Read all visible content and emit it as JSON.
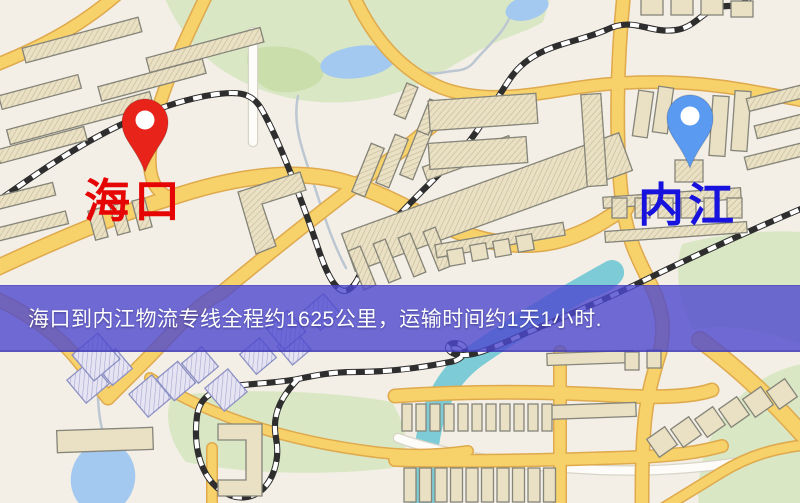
{
  "banner": {
    "text": "海口到内江物流专线全程约1625公里，运输时间约1天1小时.",
    "bg": "rgba(78,72,206,0.80)",
    "text_color": "#ffffff",
    "top": 285,
    "height": 67,
    "pad_left": 28
  },
  "markers": [
    {
      "id": "origin",
      "label": "海口",
      "label_color": "#e60505",
      "pin_color": "#e8231a",
      "x": 145,
      "y": 172,
      "label_x": 84,
      "label_y": 178,
      "label_size": 46
    },
    {
      "id": "destination",
      "label": "内江",
      "label_color": "#1712dd",
      "pin_color": "#5a9af0",
      "x": 690,
      "y": 168,
      "label_x": 638,
      "label_y": 182,
      "label_size": 46
    }
  ],
  "map": {
    "bg": "#f3efe6",
    "road_color": "#f7d169",
    "road_casing": "#dfa94d",
    "minor_road_color": "#fdfcf8",
    "minor_road_casing": "#d8d4c8",
    "railway_dark": "#2e2e2e",
    "railway_light": "#ffffff",
    "building_fill": "#eae0c4",
    "building_stroke": "#85857a",
    "building_blue_fill": "#e6e4f2",
    "building_blue_stroke": "#8d92c4",
    "green": "#d9e7c4",
    "green_dark": "#c9deaa",
    "pond": "#a3c9f0",
    "river": "#7ccbd6",
    "stream": "#bcc7d2",
    "greens": [
      {
        "d": "M 162,-8 C 178,30 200,58 232,76 C 272,99 322,108 372,99 C 420,91 455,62 488,46 C 506,37 526,32 543,22 L 552,-8 Z",
        "c": "green"
      },
      {
        "d": "M 250,50 C 280,42 310,48 322,66 C 330,82 305,94 280,92 C 255,90 240,62 250,50 Z",
        "c": "green_dark"
      },
      {
        "d": "M 682,244 C 728,232 778,229 812,233 L 812,348 C 772,332 724,322 694,330 C 678,300 674,268 682,244 Z",
        "c": "green"
      },
      {
        "d": "M 812,362 C 772,368 742,388 722,418 C 702,448 696,478 699,512 L 812,512 Z",
        "c": "green"
      },
      {
        "d": "M 172,396 C 230,388 330,390 392,402 C 412,436 408,458 392,468 C 330,476 240,474 186,462 C 168,440 164,414 172,396 Z",
        "c": "green"
      }
    ],
    "streams": [
      "M 298,96 C 292,125 303,152 313,182 C 322,208 330,238 346,268",
      "M 512,12 C 504,34 487,46 474,62 C 466,72 455,70 446,72 C 428,76 410,70 396,64",
      "M 95,354 C 100,380 94,410 106,442"
    ],
    "ponds": [
      {
        "cx": 358,
        "cy": 62,
        "rx": 38,
        "ry": 16,
        "a": -8,
        "c": "pond"
      },
      {
        "cx": 103,
        "cy": 478,
        "rx": 32,
        "ry": 36,
        "a": 14,
        "c": "pond"
      },
      {
        "cx": 527,
        "cy": 8,
        "rx": 22,
        "ry": 12,
        "a": -15,
        "c": "pond"
      },
      {
        "cx": 598,
        "cy": 282,
        "rx": 28,
        "ry": 13,
        "a": -24,
        "c": "river"
      }
    ],
    "rivers": [
      {
        "d": "M 612,272 C 565,298 515,328 475,356 C 445,378 432,408 427,445 C 424,470 423,488 422,510",
        "w": 24
      }
    ],
    "minor_roads": [
      {
        "d": "M 253,32 L 253,142",
        "w": 8
      },
      {
        "d": "M 398,438 C 448,456 515,466 600,470 C 650,472 700,468 740,462",
        "w": 8
      }
    ],
    "roads": [
      {
        "d": "M -12,68 C 35,50 80,28 122,-10",
        "w": 11
      },
      {
        "d": "M 208,-8 C 176,58 153,108 150,152 C 148,180 156,192 170,198",
        "w": 11
      },
      {
        "d": "M -12,272 C 60,238 125,212 170,198 C 235,176 295,168 345,182 C 400,198 435,228 485,240 C 540,252 575,238 602,222 C 616,213 622,210 626,208",
        "w": 14
      },
      {
        "d": "M 222,292 C 280,244 345,193 405,148 C 428,130 448,112 464,100",
        "w": 12
      },
      {
        "d": "M 352,-8 C 372,38 402,72 442,88 C 485,104 530,95 575,88 C 640,78 700,82 745,90 C 768,94 790,98 812,102",
        "w": 11
      },
      {
        "d": "M 624,-8 C 617,60 615,140 622,200 C 628,248 644,268 656,296 C 664,318 664,330 660,352",
        "w": 12
      },
      {
        "d": "M 660,352 C 652,378 646,400 644,430 C 642,455 642,480 642,510",
        "w": 12
      },
      {
        "d": "M -12,295 C 28,312 58,335 78,360 L 108,398",
        "w": 12
      },
      {
        "d": "M 108,398 L 148,358 C 168,338 195,305 222,292",
        "w": 12
      },
      {
        "d": "M 150,378 C 215,420 295,442 375,452 C 415,457 445,454 468,451",
        "w": 9
      },
      {
        "d": "M 212,448 L 212,510",
        "w": 9
      },
      {
        "d": "M 395,396 C 480,390 560,392 625,396 C 668,398 695,396 712,390",
        "w": 12
      },
      {
        "d": "M 395,460 C 470,462 560,460 640,457 C 680,455 700,452 722,446",
        "w": 11
      },
      {
        "d": "M 560,352 L 560,510",
        "w": 11
      },
      {
        "d": "M 700,340 C 738,368 770,398 802,434",
        "w": 15
      },
      {
        "d": "M 660,510 L 722,472 C 750,455 775,448 812,444",
        "w": 9
      }
    ],
    "railways": [
      "M -12,208 C 58,158 125,112 205,96 C 238,90 252,92 262,110 C 278,138 300,195 318,248 C 328,278 338,295 348,290 C 360,284 362,262 376,243 C 398,212 430,185 462,150 C 482,128 496,98 512,76 C 536,44 574,44 606,30 C 634,16 648,34 676,30 C 698,27 704,6 728,6 C 742,6 748,2 752,-8",
      "M 815,203 C 760,226 700,253 645,280 C 605,300 560,318 515,338 C 488,350 470,358 455,354 C 443,350 448,340 460,344 C 470,348 464,360 450,362 C 420,368 390,372 355,372 C 330,372 312,376 298,379 C 250,388 202,378 197,416 C 192,456 206,490 236,497 C 266,502 282,468 276,438 C 271,412 284,394 298,379"
    ],
    "buildings": [
      [
        82,
        40,
        120,
        15,
        -15,
        "h"
      ],
      [
        205,
        50,
        118,
        15,
        -15,
        "h"
      ],
      [
        152,
        80,
        108,
        15,
        -15,
        "h"
      ],
      [
        40,
        92,
        82,
        14,
        -15,
        "h"
      ],
      [
        80,
        118,
        148,
        15,
        -15,
        "h"
      ],
      [
        42,
        145,
        90,
        14,
        -15,
        "h"
      ],
      [
        25,
        196,
        60,
        13,
        -14,
        "h"
      ],
      [
        32,
        226,
        72,
        13,
        -14,
        "h"
      ],
      [
        98,
        224,
        13,
        30,
        -15,
        "h"
      ],
      [
        120,
        219,
        13,
        30,
        -15,
        "h"
      ],
      [
        142,
        214,
        13,
        30,
        -15,
        "h"
      ],
      [
        368,
        170,
        14,
        52,
        22,
        "h"
      ],
      [
        392,
        161,
        14,
        52,
        22,
        "h"
      ],
      [
        416,
        153,
        14,
        52,
        22,
        "h"
      ],
      [
        406,
        101,
        12,
        34,
        22,
        "h"
      ],
      [
        429,
        117,
        12,
        34,
        22,
        "h"
      ],
      [
        487,
        202,
        295,
        40,
        -20,
        "h"
      ],
      [
        468,
        158,
        92,
        14,
        -20,
        "h"
      ],
      [
        483,
        112,
        108,
        30,
        -4,
        "h"
      ],
      [
        478,
        153,
        98,
        26,
        -4,
        "h"
      ],
      [
        594,
        140,
        20,
        92,
        -4,
        "h"
      ],
      [
        643,
        114,
        15,
        46,
        8,
        "p"
      ],
      [
        663,
        110,
        15,
        46,
        8,
        "p"
      ],
      [
        719,
        126,
        16,
        60,
        4,
        "p"
      ],
      [
        741,
        121,
        16,
        60,
        4,
        "p"
      ],
      [
        689,
        171,
        28,
        22,
        0,
        "h"
      ],
      [
        776,
        98,
        58,
        13,
        -14,
        "h"
      ],
      [
        781,
        126,
        52,
        13,
        -14,
        "h"
      ],
      [
        776,
        156,
        62,
        13,
        -14,
        "h"
      ],
      [
        652,
        7,
        22,
        16,
        0,
        "p"
      ],
      [
        682,
        7,
        22,
        16,
        0,
        "p"
      ],
      [
        712,
        7,
        22,
        16,
        0,
        "p"
      ],
      [
        742,
        9,
        22,
        16,
        0,
        "p"
      ],
      [
        362,
        268,
        13,
        42,
        -22,
        "h"
      ],
      [
        387,
        261,
        13,
        42,
        -22,
        "h"
      ],
      [
        412,
        255,
        13,
        42,
        -22,
        "h"
      ],
      [
        437,
        249,
        13,
        42,
        -22,
        "h"
      ],
      [
        500,
        240,
        130,
        13,
        -10,
        "h"
      ],
      [
        456,
        257,
        16,
        16,
        -10,
        "p"
      ],
      [
        479,
        252,
        16,
        16,
        -10,
        "p"
      ],
      [
        502,
        248,
        16,
        16,
        -10,
        "p"
      ],
      [
        525,
        243,
        16,
        16,
        -10,
        "p"
      ],
      [
        672,
        198,
        138,
        11,
        -4,
        "h"
      ],
      [
        676,
        232,
        142,
        11,
        -4,
        "h"
      ],
      [
        105,
        440,
        96,
        22,
        -2,
        "p"
      ],
      [
        88,
        382,
        30,
        30,
        -40,
        "b"
      ],
      [
        114,
        367,
        26,
        26,
        -40,
        "b"
      ],
      [
        150,
        396,
        30,
        30,
        -40,
        "b"
      ],
      [
        176,
        381,
        28,
        28,
        -40,
        "b"
      ],
      [
        200,
        365,
        26,
        26,
        -40,
        "b"
      ],
      [
        226,
        390,
        30,
        30,
        -40,
        "b"
      ],
      [
        258,
        356,
        26,
        26,
        -40,
        "b"
      ],
      [
        294,
        348,
        24,
        24,
        -40,
        "b"
      ],
      [
        96,
        357,
        34,
        34,
        -40,
        "b"
      ],
      [
        286,
        330,
        28,
        28,
        -40,
        "b"
      ],
      [
        322,
        312,
        26,
        26,
        -40,
        "b"
      ],
      [
        590,
        411,
        92,
        14,
        -2,
        "p"
      ],
      [
        590,
        358,
        86,
        12,
        -2,
        "p"
      ],
      [
        632,
        361,
        14,
        18,
        0,
        "p"
      ],
      [
        654,
        359,
        14,
        18,
        0,
        "p"
      ],
      [
        662,
        442,
        22,
        22,
        -35,
        "p"
      ],
      [
        686,
        432,
        22,
        22,
        -35,
        "p"
      ],
      [
        710,
        422,
        22,
        22,
        -35,
        "p"
      ],
      [
        734,
        412,
        22,
        22,
        -35,
        "p"
      ],
      [
        758,
        402,
        22,
        22,
        -35,
        "p"
      ],
      [
        782,
        394,
        22,
        22,
        -35,
        "p"
      ]
    ],
    "building_rows": [
      {
        "x": 402,
        "y": 404,
        "w": 10,
        "h": 27,
        "dx": 14,
        "n": 11,
        "v": "p"
      },
      {
        "x": 404,
        "y": 468,
        "w": 12,
        "h": 34,
        "dx": 15.5,
        "n": 10,
        "v": "p"
      },
      {
        "x": 612,
        "y": 198,
        "w": 15,
        "h": 20,
        "dx": 23,
        "n": 6,
        "v": "h"
      }
    ],
    "building_polys": [
      {
        "points": "238,192 300,172 306,190 262,204 276,246 256,254",
        "v": "h"
      },
      {
        "points": "218,424 262,424 262,496 218,496 218,480 246,480 246,440 218,440",
        "v": "p"
      }
    ]
  }
}
